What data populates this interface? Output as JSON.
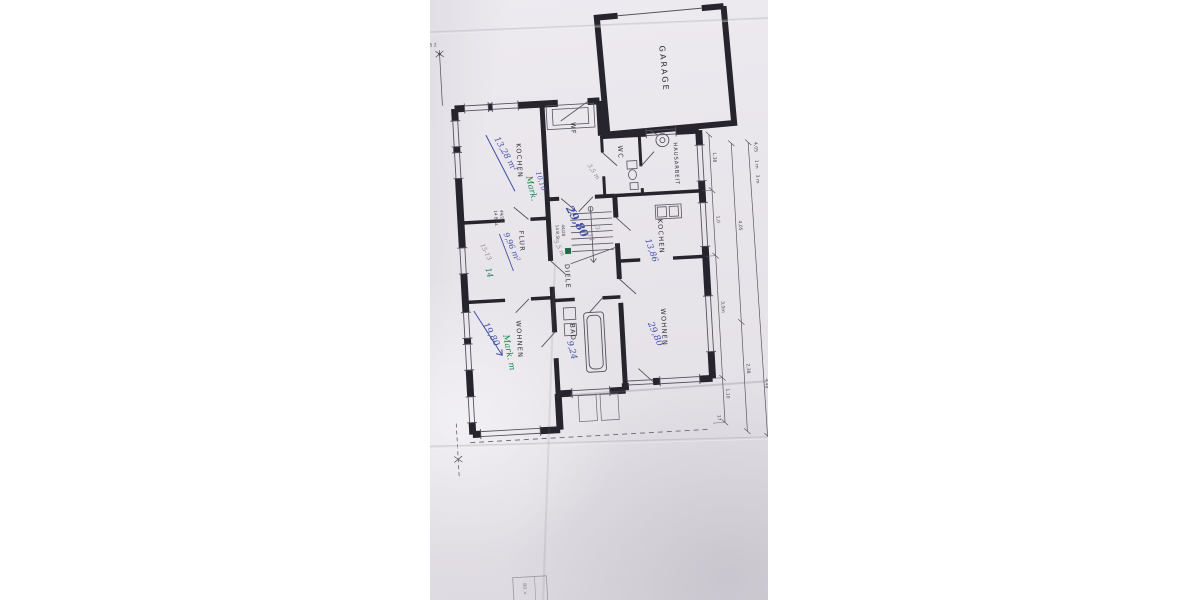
{
  "photo": {
    "description": "Photographed hand-drawn floor plan sheet, rotated 90 degrees, lying on white background",
    "colors": {
      "paper": "#e8e5eb",
      "ink": "#26242c",
      "thin_line": "#55525e",
      "pencil": "#8a8795",
      "pen_blue": "#4050a8",
      "pen_green": "#1d7f4a",
      "margin": "#ffffff"
    }
  },
  "plan": {
    "rooms": {
      "garage": {
        "label": "GARAGE"
      },
      "hausarbeit": {
        "label": "HAUSARBEIT"
      },
      "wf": {
        "label": "WF"
      },
      "wc": {
        "label": "WC"
      },
      "kochen1": {
        "label": "KOCHEN",
        "area_blue": "13,28 m²",
        "note_green": "Mark."
      },
      "kochen2": {
        "label": "KOCHEN",
        "area_blue": "13,86"
      },
      "flur": {
        "label": "FLUR",
        "area_blue": "9,96 m²",
        "note_pencil": "15-13",
        "note_green": "14"
      },
      "diele": {
        "label": "DIELE",
        "area_blue": "29,80",
        "len_blue": "10,10",
        "note_pencil_1": "3,5 m",
        "note_pencil_2": "3,5 m",
        "note_pencil_3": "-3-",
        "note_pencil_4": "14"
      },
      "wohnen_right": {
        "label": "WOHNEN",
        "area_blue": "29,80"
      },
      "wohnen_left": {
        "label": "WOHNEN",
        "area_blue": "19,80",
        "note_green": "Mark. m"
      },
      "bad": {
        "label": "BAD",
        "area_blue": "9,24"
      }
    },
    "stairs": {
      "spec_1": "44/28",
      "spec_2": "14 B.St.",
      "spec_3": "44/28",
      "spec_4": "14 B.St."
    },
    "dimensions": {
      "d1": "1,38",
      "d2": "1,0",
      "d3": "3,0m",
      "d4": "1,10",
      "d5": "17",
      "d6": "4,05",
      "d7": "2,38",
      "d8": "4,48",
      "d9": "4,05",
      "d10": "1 m",
      "d11": "3 m",
      "d12": "2,5 2"
    },
    "fragment": {
      "text": "80 ×"
    }
  }
}
